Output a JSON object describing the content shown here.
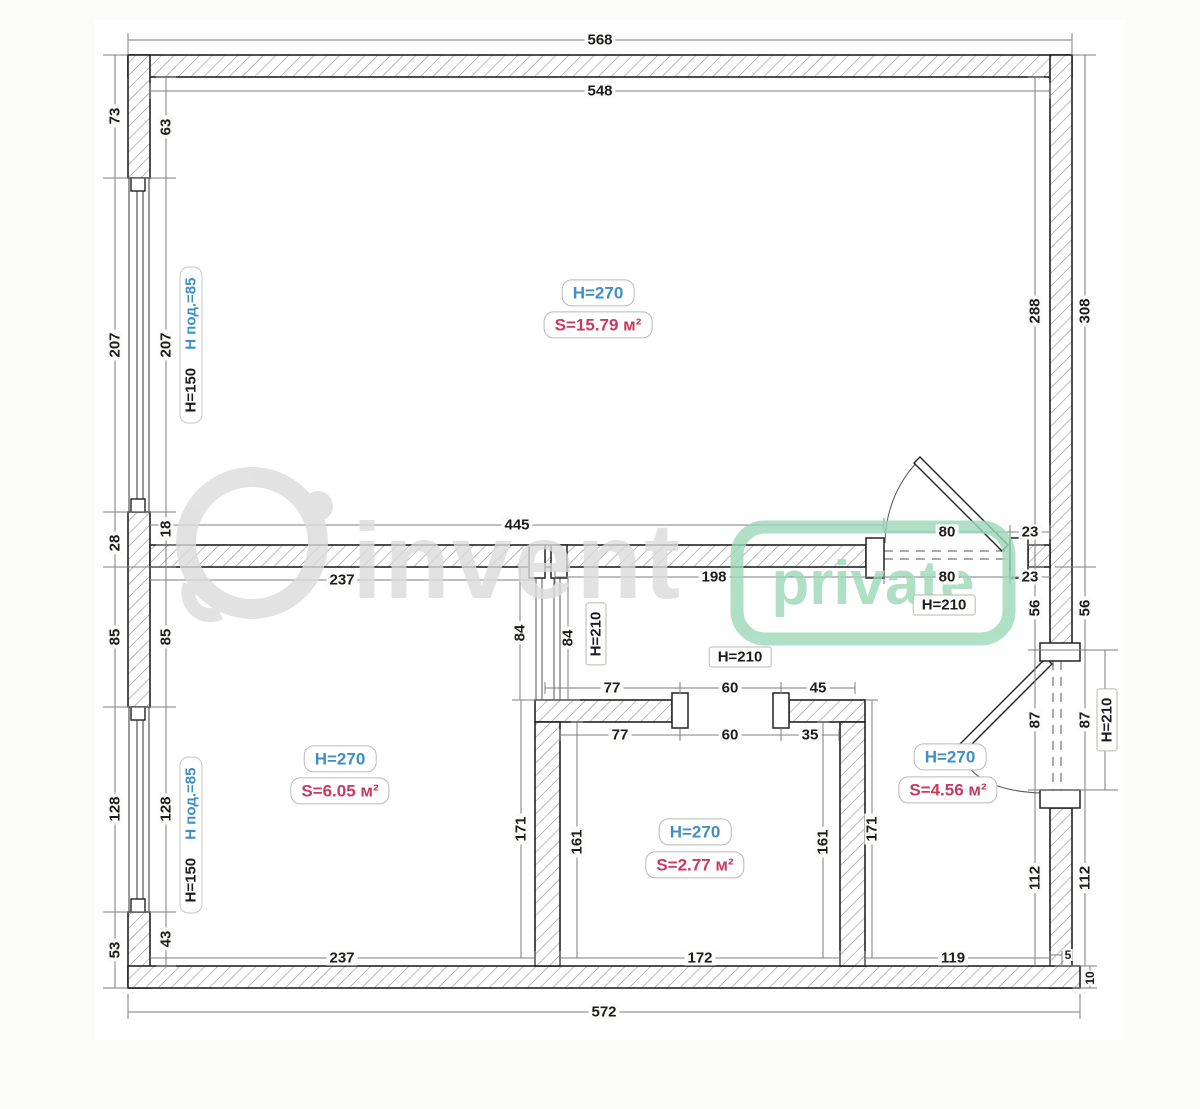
{
  "watermark": {
    "brand": "invent",
    "tag": "private"
  },
  "rooms": {
    "main": {
      "height": "H=270",
      "area": "S=15.79 м²"
    },
    "left": {
      "height": "H=270",
      "area": "S=6.05 м²"
    },
    "bath": {
      "height": "H=270",
      "area": "S=2.77 м²"
    },
    "hall": {
      "height": "H=270",
      "area": "S=4.56 м²"
    }
  },
  "window_label": {
    "h": "H=150",
    "sill": "H под.=85"
  },
  "door_label": {
    "h210": "H=210"
  },
  "dims": {
    "d568": "568",
    "d548": "548",
    "d73": "73",
    "d63": "63",
    "d207": "207",
    "d28": "28",
    "d18": "18",
    "d85": "85",
    "d128": "128",
    "d53": "53",
    "d43": "43",
    "d288": "288",
    "d308": "308",
    "d23": "23",
    "d56": "56",
    "d87": "87",
    "d112": "112",
    "d445": "445",
    "d80": "80",
    "d237": "237",
    "d198": "198",
    "d84": "84",
    "d77": "77",
    "d60": "60",
    "d45": "45",
    "d35": "35",
    "d171": "171",
    "d161": "161",
    "d172": "172",
    "d119": "119",
    "d5": "5",
    "d10": "10",
    "d572": "572"
  },
  "colors": {
    "height_label": "#3f8fc5",
    "area_label": "#c93a5f",
    "watermark_gray": "#dcdcdc",
    "watermark_green": "#9cd9b9"
  }
}
